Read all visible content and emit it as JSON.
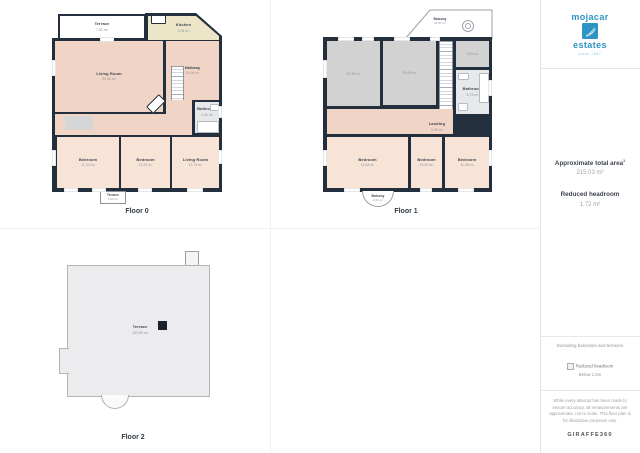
{
  "sidebar": {
    "logo": {
      "word1": "mojacar",
      "word2": "estates",
      "tagline": "since 1987"
    },
    "stats": {
      "total_area_label": "Approximate total area",
      "total_area_sup": "1",
      "total_area_value": "215.03 m²",
      "headroom_label": "Reduced headroom",
      "headroom_value": "1.72 m²"
    },
    "notes": {
      "excluding": "Excluding balconies and terraces"
    },
    "legend": {
      "line1": "Reduced headroom",
      "line2": "Below 1.5m"
    },
    "disclaimer": "While every attempt has been made to ensure accuracy, all measurements are approximate, not to scale. This floor plan is for illustrative purposes only.",
    "brand": "GIRAFFE360"
  },
  "floors": [
    {
      "caption": "Floor 0",
      "rooms": {
        "terrace_top": {
          "name": "Terrace",
          "area": "7.52 m²"
        },
        "kitchen": {
          "name": "Kitchen",
          "area": "9.28 m²"
        },
        "living": {
          "name": "Living Room",
          "area": "34.94 m²"
        },
        "hallway": {
          "name": "Hallway",
          "area": "14.04 m²"
        },
        "bathroom": {
          "name": "Bathroom",
          "area": "4.00 m²"
        },
        "bedroom_l": {
          "name": "Bedroom",
          "area": "11.20 m²"
        },
        "bedroom_m": {
          "name": "Bedroom",
          "area": "13.22 m²"
        },
        "living2": {
          "name": "Living Room",
          "area": "13.73 m²"
        },
        "terrace_bottom": {
          "name": "Terrace",
          "area": "4.20 m²"
        }
      }
    },
    {
      "caption": "Floor 1",
      "rooms": {
        "balcony_top": {
          "name": "Balcony",
          "area": "14.37 m²"
        },
        "room_a": {
          "name": "",
          "area": "15.39 m²"
        },
        "room_b": {
          "name": "",
          "area": "20.69 m²"
        },
        "room_c": {
          "name": "",
          "area": "4.53 m²"
        },
        "bathroom": {
          "name": "Bathroom",
          "area": "5.73 m²"
        },
        "landing": {
          "name": "Landing",
          "area": "9.76 m²"
        },
        "bedroom_l": {
          "name": "Bedroom",
          "area": "14.64 m²"
        },
        "bedroom_m": {
          "name": "Bedroom",
          "area": "10.52 m²"
        },
        "bedroom_r": {
          "name": "Bedroom",
          "area": "11.28 m²"
        },
        "balcony_bottom": {
          "name": "Balcony",
          "area": "2.21 m²"
        }
      }
    },
    {
      "caption": "Floor 2",
      "rooms": {
        "terrace": {
          "name": "Terrace",
          "area": "152.80 m²"
        }
      }
    }
  ]
}
